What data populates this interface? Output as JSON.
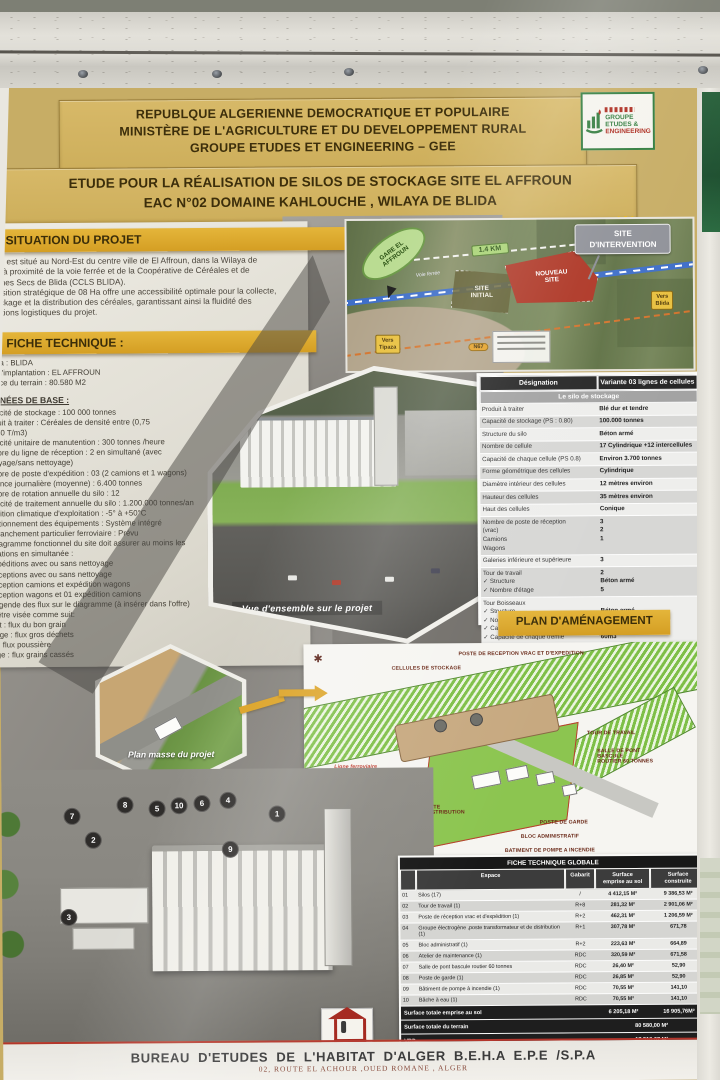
{
  "poster": {
    "header": {
      "line1": "REPUBLQUE ALGERIENNE DEMOCRATIQUE ET POPULAIRE",
      "line2": "MINISTÈRE DE L'AGRICULTURE ET DU DEVELOPPEMENT RURAL",
      "line3": "GROUPE  ETUDES ET ENGINEERING  – GEE",
      "title_line1": "ETUDE POUR LA RÉALISATION DE SILOS DE STOCKAGE SITE EL AFFROUN",
      "title_line2": "EAC N°02  DOMAINE KAHLOUCHE  , WILAYA DE BLIDA"
    },
    "gee_logo": {
      "l1": "GROUPE",
      "l2": "ETUDES &",
      "l3": "ENGINEERING"
    },
    "oaic": {
      "label": "OAIC"
    },
    "situation": {
      "heading": "SITUATION DU PROJET",
      "lines": [
        "Le site est situé au Nord-Est du centre ville de El Affroun, dans la Wilaya de",
        "Blida, à proximité de la voie ferrée et de la Coopérative de Céréales et de",
        "Légumes Secs de Blida (CCLS BLIDA).",
        "Sa position stratégique de 08 Ha offre une accessibilité optimale pour la collecte,",
        "le stockage et la distribution des céréales, garantissant ainsi la fluidité des",
        "opérations logistiques du projet."
      ]
    },
    "fiche": {
      "heading": "FICHE TECHNIQUE :",
      "items": [
        "Wilaya : BLIDA",
        "Lieu d'implantation  : EL AFFROUN",
        "Surface du terrain    : 80.580 M2"
      ],
      "donnees_heading": "DONNÉES DE BASE :",
      "lines": [
        "Capacité de stockage : 100 000 tonnes",
        "Produit à traiter : Céréales de densité entre (0,75",
        "et 0,80 T/m3)",
        "Capacité unitaire de manutention : 300 tonnes /heure",
        "Nombre du ligne de réception : 2 en simultané (avec",
        "nettoyage/sans nettoyage)",
        "Nombre de poste d'expédition : 03 (2 camions et 1 wagons)",
        "Cadence journalière (moyenne) : 6.400 tonnes",
        "Nombre de rotation annuelle du silo : 12",
        "Capacité de traitement annuelle du silo : 1.200.000 tonnes/an",
        "Condition climatique d'exploitation : -5° à +50°C",
        "Fonctionnement des équipements : Système intégré",
        "Embranchement particulier ferroviaire : Prévu",
        "Le diagramme fonctionnel du site doit assurer au moins les",
        "opérations en simultanée :",
        "2 Expéditions avec ou sans nettoyage",
        "2 Réceptions avec ou sans nettoyage",
        "1 Réception camions et expédition wagons",
        "1 Réception wagons et 01 expédition camions",
        "La légende des flux sur le diagramme (à insérer dans l'offre)",
        "doit être visée comme suit:",
        "Violet : flux du bon grain",
        "Orange : flux gros déchets",
        "Vert : flux poussière",
        "Rouge : flux grains cassés"
      ]
    },
    "map": {
      "intervention": "SITE\nD'INTERVENTION",
      "gare": "GARE EL\nAFFROUN",
      "distance": "1.4 KM",
      "voie": "Voie ferrée",
      "site_initial": "SITE\nINITIAL",
      "nouveau_site": "NOUVEAU\nSITE",
      "vers_blida": "Vers\nBlida",
      "vers_tipaza": "Vers\nTipaza",
      "route": "N67"
    },
    "vue_caption": "Vue d'ensemble sur le projet",
    "silo_table": {
      "col1": "Désignation",
      "col2": "Variante 03 lignes de cellules",
      "subheader": "Le silo de stockage",
      "rows": [
        {
          "l": "Produit à traiter",
          "v": "Blé dur et tendre"
        },
        {
          "l": "Capacité de stockage (PS : 0.80)",
          "v": "100.000 tonnes"
        },
        {
          "l": "Structure du silo",
          "v": "Béton armé"
        },
        {
          "l": "Nombre de cellule",
          "v": "17 Cylindrique +12 intercellules"
        },
        {
          "l": "Capacité de chaque cellule (PS 0.8)",
          "v": "Environ 3.700 tonnes"
        },
        {
          "l": "Forme géométrique des cellules",
          "v": "Cylindrique"
        },
        {
          "l": "Diamètre intérieur des cellules",
          "v": "12 mètres environ"
        },
        {
          "l": "Hauteur des cellules",
          "v": "35 mètres environ"
        },
        {
          "l": "Haut des cellules",
          "v": "Conique"
        },
        {
          "l": "Nombre de poste de réception\n(vrac)\nCamions\nWagons",
          "v": "3\n2\n1"
        },
        {
          "l": "Galeries inférieure et supérieure",
          "v": "3"
        },
        {
          "l": "Tour de travail\n✓ Structure\n✓ Nombre d'étage",
          "v": "2\nBéton armé\n5"
        },
        {
          "l": "Tour Boisseaux\n✓ Structure\n✓ Nombre d'étage\n✓ Capacité de chaque boisseau\n✓ Capacité de chaque trémie",
          "v": "\nBéton armé\nSuivant besoins\n75m3\n60m3"
        }
      ]
    },
    "plan": {
      "heading": "PLAN D'AMÉNAGEMENT",
      "masse_caption": "Plan masse du projet",
      "labels": [
        {
          "text": "CELLULES DE STOCKAGE",
          "x": 88,
          "y": 22,
          "red": false
        },
        {
          "text": "POSTE DE RECEPTION VRAC ET D'EXPEDITION",
          "x": 155,
          "y": 8,
          "red": false
        },
        {
          "text": "TOUR DE TRAVAIL",
          "x": 283,
          "y": 88,
          "red": false
        },
        {
          "text": "SALLE DE PONT BASCULE\nROUTIER 60 TONNES",
          "x": 293,
          "y": 106,
          "red": false
        },
        {
          "text": "Ligne ferroviaire",
          "x": 30,
          "y": 120,
          "red": true
        },
        {
          "text": "BACHE A EAU",
          "x": 52,
          "y": 132,
          "red": false
        },
        {
          "text": "ATELIER DE MAINTENANCE",
          "x": 55,
          "y": 147,
          "red": false
        },
        {
          "text": "GROUPE ELECTROGENE,POSTE\nTRANSFORMATEUR ET DE DISTRIBUTION",
          "x": 50,
          "y": 161,
          "red": false
        },
        {
          "text": "POSTE DE GARDE",
          "x": 235,
          "y": 177,
          "red": false
        },
        {
          "text": "BLOC ADMINISTRATIF",
          "x": 216,
          "y": 191,
          "red": false
        },
        {
          "text": "BATIMENT DE POMPE A INCENDIE",
          "x": 200,
          "y": 205,
          "red": false
        }
      ]
    },
    "render": {
      "voie_label": "VOIE FERRÉE",
      "markers": [
        {
          "n": "8",
          "x": 123,
          "y": 715
        },
        {
          "n": "5",
          "x": 155,
          "y": 719
        },
        {
          "n": "10",
          "x": 177,
          "y": 716
        },
        {
          "n": "6",
          "x": 200,
          "y": 714
        },
        {
          "n": "4",
          "x": 226,
          "y": 711
        },
        {
          "n": "1",
          "x": 275,
          "y": 725
        },
        {
          "n": "7",
          "x": 70,
          "y": 726
        },
        {
          "n": "2",
          "x": 91,
          "y": 750
        },
        {
          "n": "9",
          "x": 228,
          "y": 760
        },
        {
          "n": "3",
          "x": 66,
          "y": 827
        }
      ]
    },
    "global_table": {
      "title": "FICHE TECHNIQUE GLOBALE",
      "columns": [
        "Espace",
        "Gabarit",
        "Surface\nemprise au sol",
        "Surface\nconstruite"
      ],
      "rows": [
        [
          "01",
          "Silos (17)",
          "/",
          "4 412,15 M²",
          "9 386,53 M²"
        ],
        [
          "02",
          "Tour de travail (1)",
          "R+8",
          "281,32 M²",
          "2 901,06 M²"
        ],
        [
          "03",
          "Poste de réception vrac et d'expédition (1)",
          "R+2",
          "462,31 M²",
          "1 206,59 M²"
        ],
        [
          "04",
          "Groupe électrogène ,poste transformateur et de distribution (1)",
          "R+1",
          "307,78 M²",
          "671,78"
        ],
        [
          "05",
          "Bloc administratif (1)",
          "R+2",
          "223,63 M²",
          "664,89"
        ],
        [
          "06",
          "Atelier de maintenance (1)",
          "RDC",
          "320,59 M²",
          "671,58"
        ],
        [
          "07",
          "Salle de pont bascule routier 60 tonnes",
          "RDC",
          "26,40 M²",
          "52,90"
        ],
        [
          "08",
          "Poste de garde (1)",
          "RDC",
          "26,85 M²",
          "52,90"
        ],
        [
          "09",
          "Bâtiment de pompe à incendie (1)",
          "RDC",
          "70,55 M²",
          "141,10"
        ],
        [
          "10",
          "Bâche à eau (1)",
          "RDC",
          "70,55 M²",
          "141,10"
        ]
      ],
      "totals": [
        [
          "Surface totale emprise au sol",
          "6 205,18 M²",
          "16 905,76M²"
        ],
        [
          "Surface totale du terrain",
          "80 580,00 M²"
        ],
        [
          "VRD",
          "17 518,67 M²"
        ],
        [
          "CES",
          "7,68"
        ],
        [
          "COS",
          "0,76"
        ]
      ]
    },
    "footer": {
      "line1": "BUREAU   D'ETUDES  DE  L'HABITAT  D'ALGER B.E.H.A     E.P.E /S.P.A",
      "line2": "02, ROUTE EL ACHOUR ,OUED ROMANE , ALGER"
    }
  },
  "colors": {
    "poster_gold": "#c9ad62",
    "banner_yellow": "#dfa21d",
    "table_header_dark": "#232323",
    "plan_green": "#7cc142",
    "map_site_red": "#b23422",
    "accent_red": "#a8231a"
  }
}
